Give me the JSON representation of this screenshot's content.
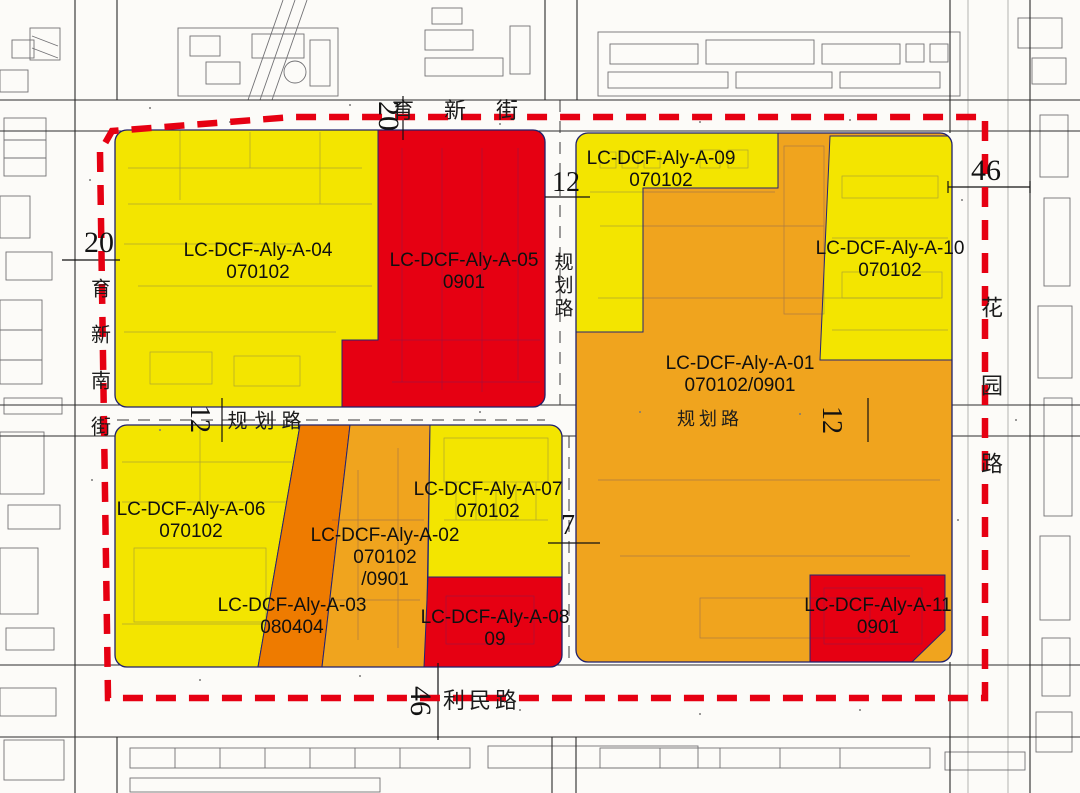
{
  "title": "urban planning regulatory parcel map",
  "colors": {
    "yellow": "#f3e500",
    "red": "#e60012",
    "orange": "#f0a41e",
    "dark_orange": "#ee7b00",
    "boundary": "#e60012"
  },
  "parcels": {
    "a04": {
      "code": "LC-DCF-Aly-A-04",
      "use": "070102"
    },
    "a05": {
      "code": "LC-DCF-Aly-A-05",
      "use": "0901"
    },
    "a09": {
      "code": "LC-DCF-Aly-A-09",
      "use": "070102"
    },
    "a10": {
      "code": "LC-DCF-Aly-A-10",
      "use": "070102"
    },
    "a01": {
      "code": "LC-DCF-Aly-A-01",
      "use": "070102/0901"
    },
    "a06": {
      "code": "LC-DCF-Aly-A-06",
      "use": "070102"
    },
    "a03": {
      "code": "LC-DCF-Aly-A-03",
      "use": "080404"
    },
    "a02": {
      "code": "LC-DCF-Aly-A-02",
      "use": "070102",
      "use2": "/0901"
    },
    "a07": {
      "code": "LC-DCF-Aly-A-07",
      "use": "070102"
    },
    "a08": {
      "code": "LC-DCF-Aly-A-08",
      "use": "09"
    },
    "a11": {
      "code": "LC-DCF-Aly-A-11",
      "use": "0901"
    }
  },
  "roads": {
    "north": "育新街",
    "west": "育新南街",
    "east": "花园路",
    "south": "利民路",
    "inner_vertical": "规划路",
    "inner_left": "规划路",
    "inner_right": "规划路"
  },
  "dims": {
    "north": "20",
    "inner_top": "12",
    "west": "20",
    "east": "46",
    "inner_left": "12",
    "inner_right": "12",
    "inner_mid": "7",
    "south": "46"
  }
}
